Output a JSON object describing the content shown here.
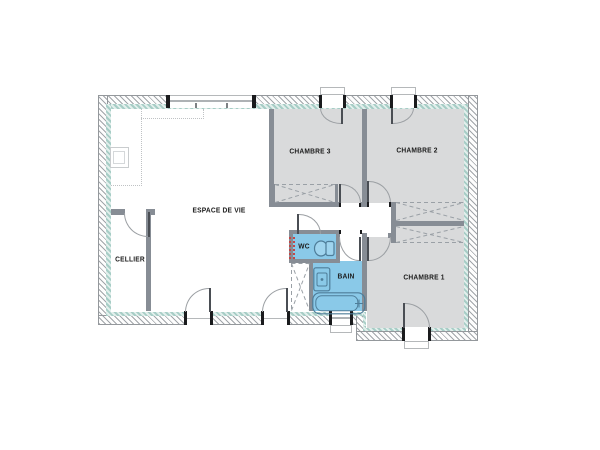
{
  "plan": {
    "rooms": {
      "espace_de_vie": {
        "label": "ESPACE DE VIE"
      },
      "cellier": {
        "label": "CELLIER"
      },
      "chambre3": {
        "label": "CHAMBRE 3"
      },
      "chambre2": {
        "label": "CHAMBRE 2"
      },
      "chambre1": {
        "label": "CHAMBRE 1"
      },
      "wc": {
        "label": "WC"
      },
      "bain": {
        "label": "BAIN"
      }
    },
    "fixtures": [
      "toilet-icon",
      "sink-icon",
      "bathtub-icon",
      "kitchen-counter",
      "kitchen-sink"
    ],
    "wardrobe_count": 4,
    "colors": {
      "exterior_wall_hatch": "#b3b6ba",
      "interior_liner_teal": "#a7cdc6",
      "interior_wall_gray": "#878d95",
      "bedroom_floor": "#d9dadb",
      "wet_room_blue": "#8ac9e8",
      "fixture_stroke": "#4e7d99",
      "utility_red": "#c24747",
      "label_text": "#1b1b1b"
    }
  }
}
